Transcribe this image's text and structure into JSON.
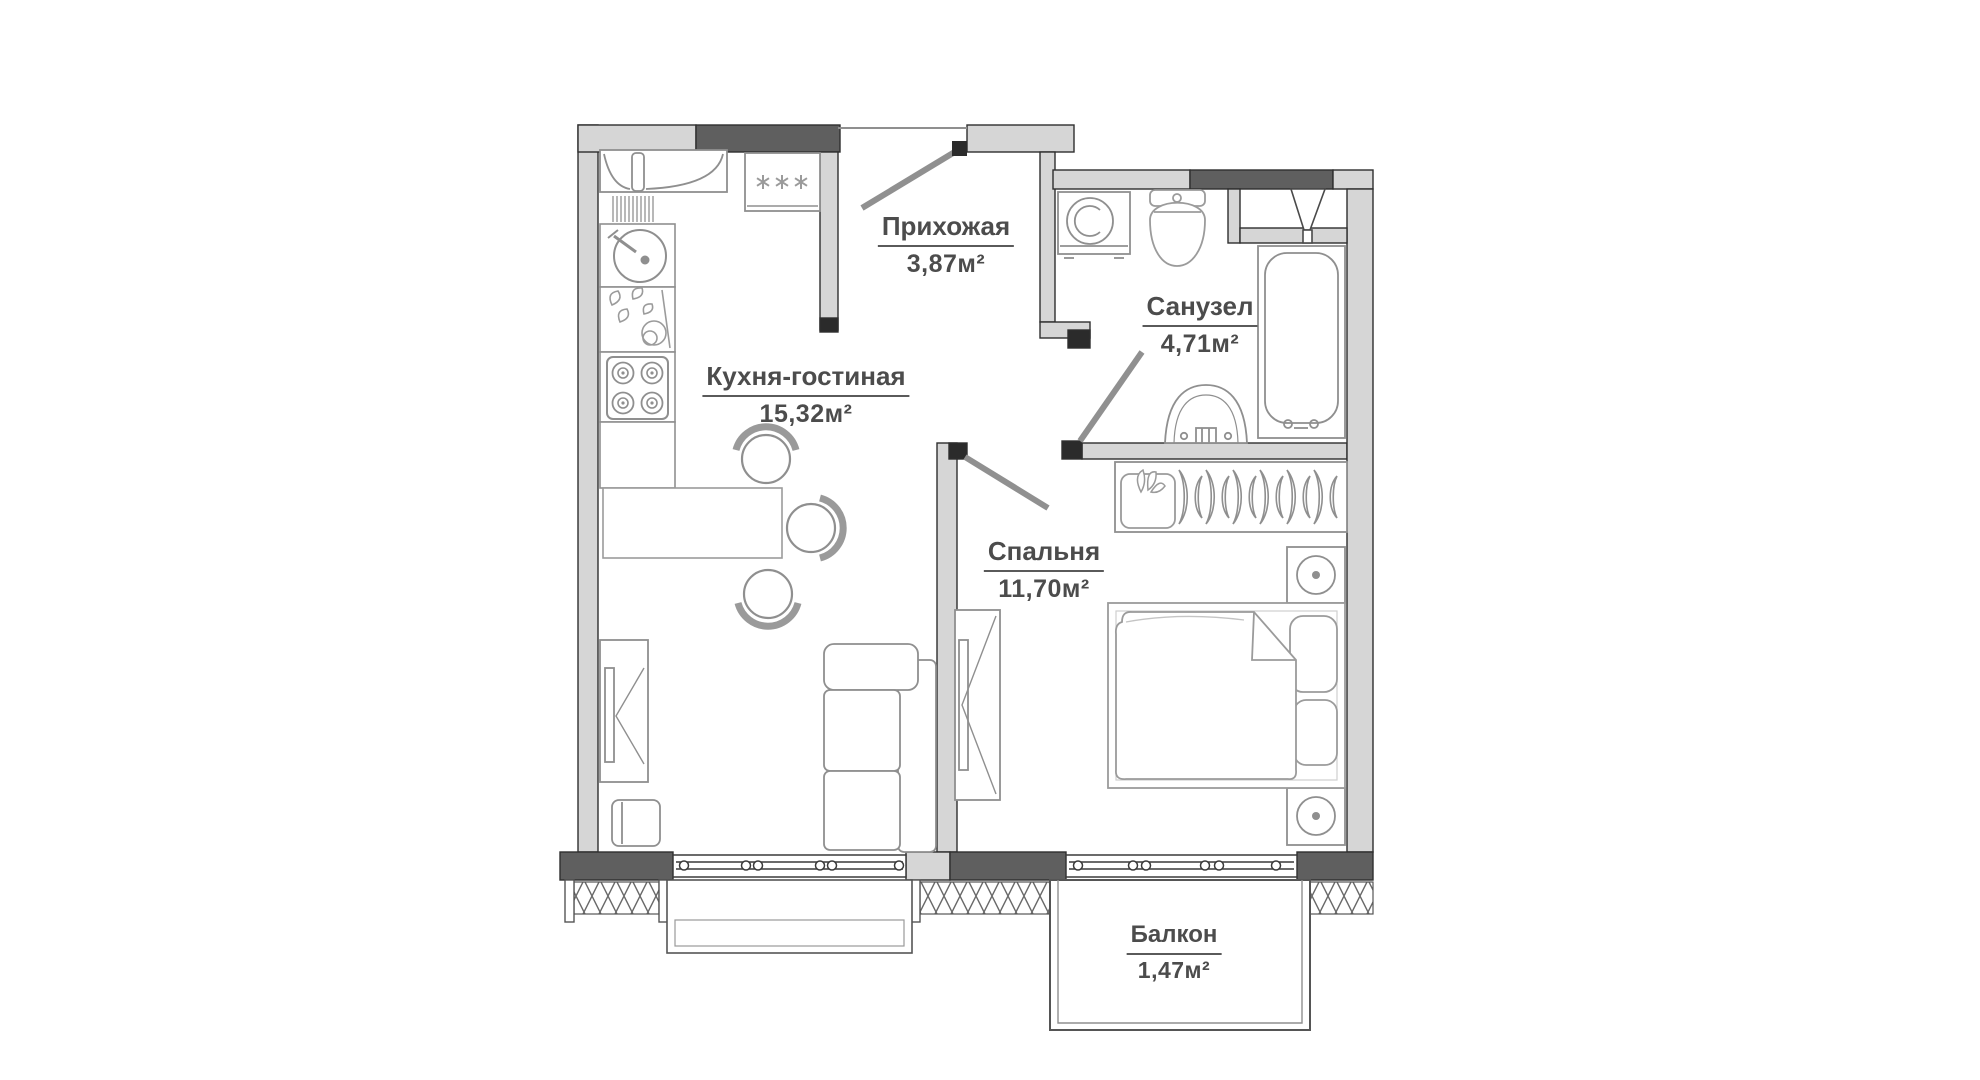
{
  "rooms": [
    {
      "id": "prihozhaya",
      "name": "Прихожая",
      "area": "3,87м²"
    },
    {
      "id": "kuhnya",
      "name": "Кухня-гостиная",
      "area": "15,32м²"
    },
    {
      "id": "sanuzel",
      "name": "Санузел",
      "area": "4,71м²"
    },
    {
      "id": "spalnya",
      "name": "Спальня",
      "area": "11,70м²"
    },
    {
      "id": "balkon",
      "name": "Балкон",
      "area": "1,47м²"
    }
  ],
  "colors": {
    "background": "#ffffff",
    "wall_fill": "#d6d6d6",
    "wall_dark": "#5f5f5f",
    "wall_outline": "#2f2f2f",
    "furniture_line": "#8f8f8f",
    "label_text": "#4c4c4c"
  },
  "fixtures": [
    "fridge-icon",
    "kitchen-hood-icon",
    "kitchen-sink-icon",
    "stove-icon",
    "dining-table-icon",
    "stool-icon",
    "sofa-icon",
    "tv-stand-icon",
    "side-table-icon",
    "washing-machine-icon",
    "toilet-icon",
    "bathtub-icon",
    "washbasin-icon",
    "hanger-rail-icon",
    "flower-box-icon",
    "bed-icon",
    "nightstand-lamp-icon",
    "mirror-wardrobe-icon",
    "vent-duct-icon",
    "entrance-door-icon",
    "interior-door-icon",
    "window-icon"
  ]
}
